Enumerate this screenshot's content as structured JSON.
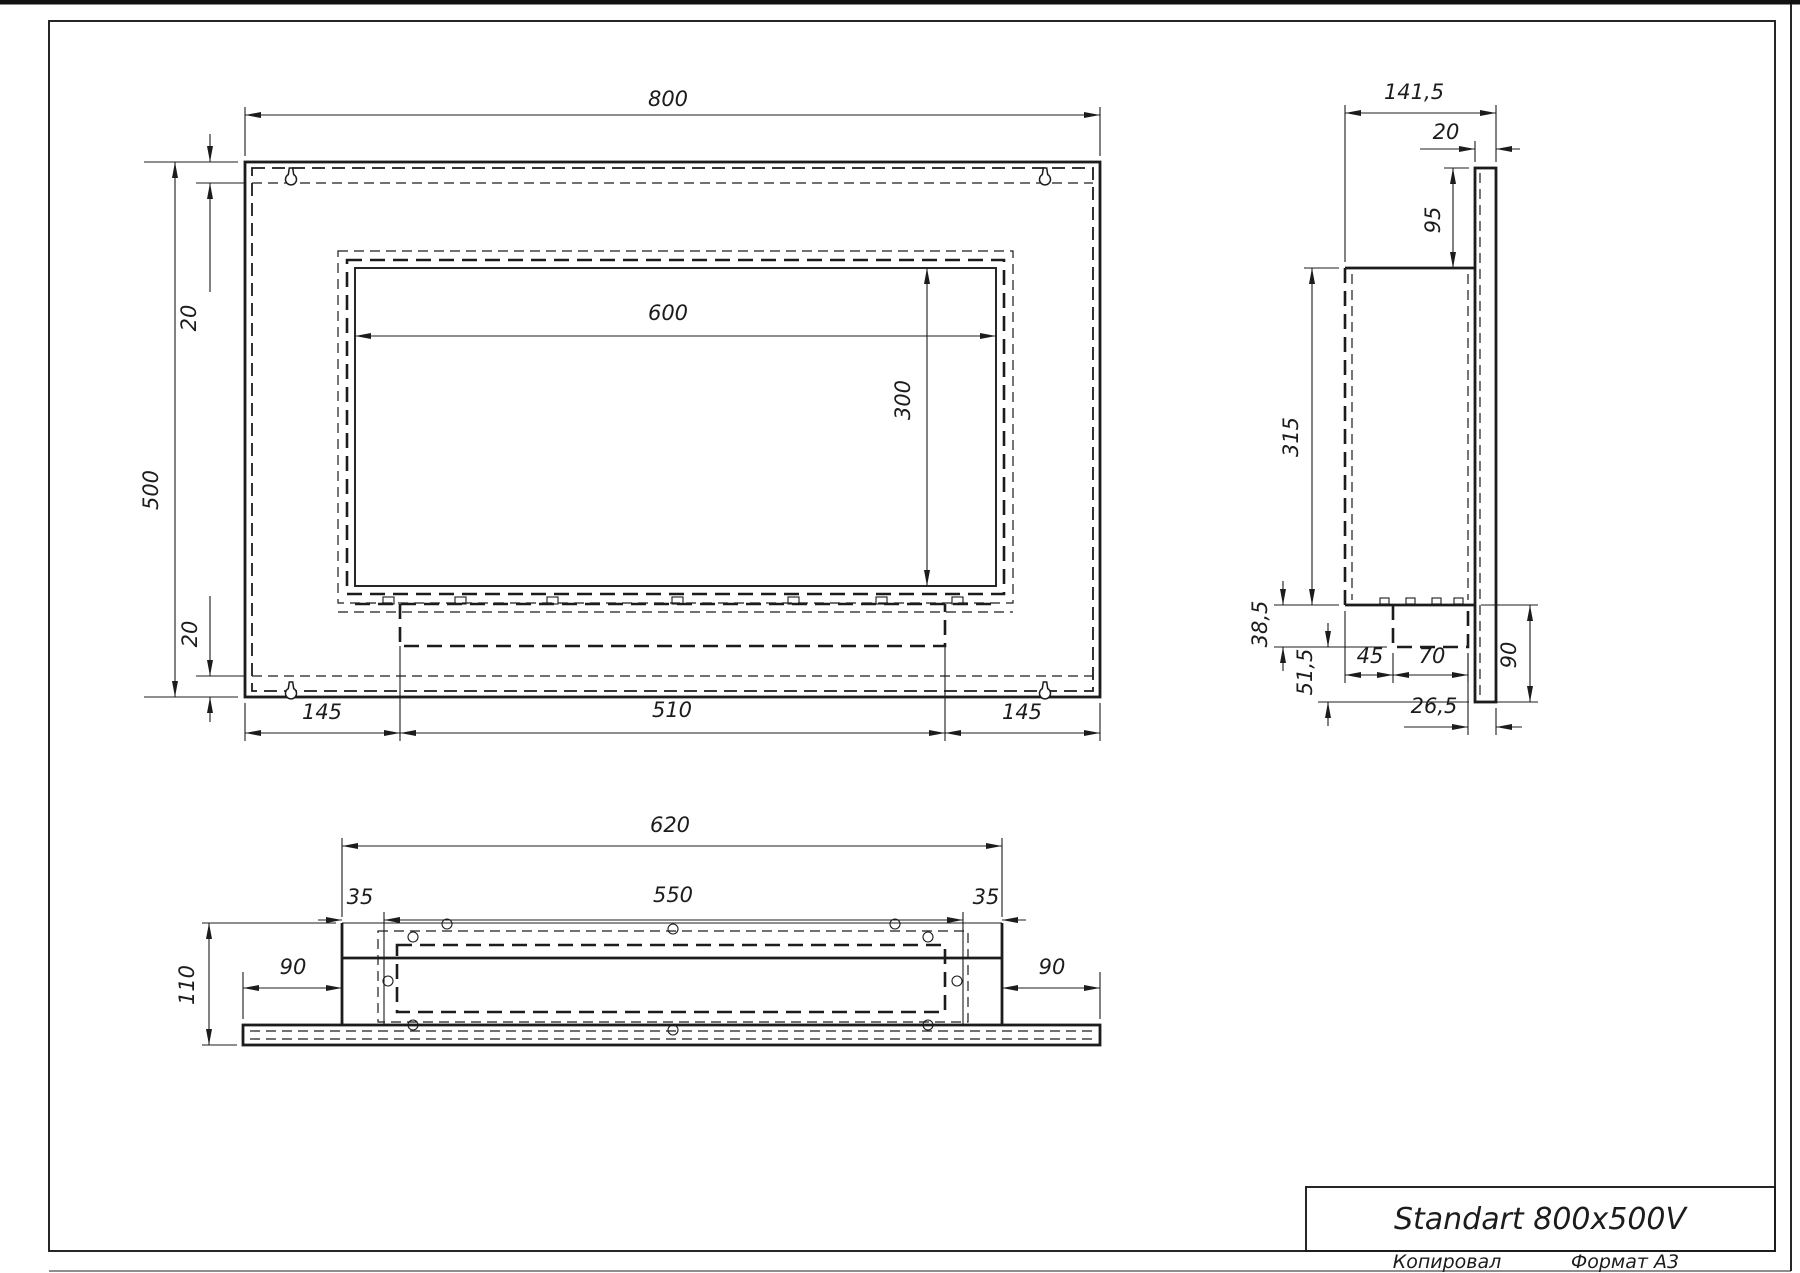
{
  "drawing": {
    "sheet_format": "Формат А3",
    "copied_label": "Копировал",
    "title": "Standart 800x500V"
  },
  "front_view": {
    "total_width": "800",
    "total_height": "500",
    "margin_top": "20",
    "margin_bottom": "20",
    "opening_width": "600",
    "opening_height": "300",
    "bottom_left": "145",
    "bottom_center": "510",
    "bottom_right": "145"
  },
  "side_view": {
    "total_depth": "141,5",
    "plate_thickness": "20",
    "plate_top_offset": "95",
    "body_height": "315",
    "tray_depth": "38,5",
    "tray_to_plate_bottom": "51,5",
    "front_to_tray": "45",
    "tray_width": "70",
    "plate_bottom_drop": "90",
    "tray_to_plate_face": "26,5"
  },
  "bottom_view": {
    "box_width": "620",
    "inner_width": "550",
    "margin_left": "35",
    "margin_right": "35",
    "total_depth": "110",
    "wing_left": "90",
    "wing_right": "90"
  },
  "colors": {
    "line": "#1c1c1c",
    "paper": "#ffffff"
  }
}
